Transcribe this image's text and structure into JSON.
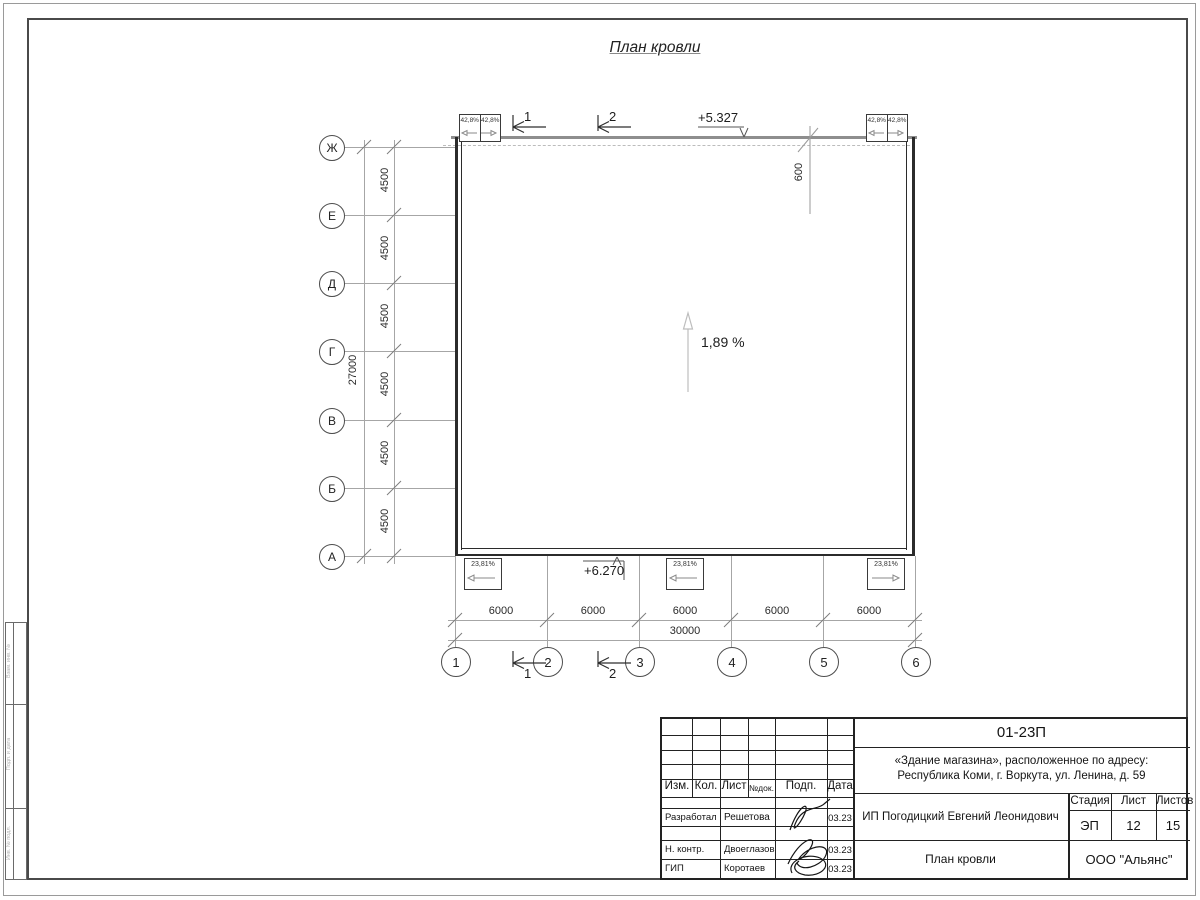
{
  "page": {
    "title": "План кровли"
  },
  "plan": {
    "slope_center": "1,89 %",
    "elevation_top": "+5.327",
    "elevation_bottom": "+6.270",
    "parapet_offset": "600",
    "section_marks": [
      "1",
      "2"
    ],
    "top_slope_cells": [
      "42,8%",
      "42,8%",
      "42,8%",
      "42,8%"
    ],
    "bottom_slope_cells": [
      "23,81%",
      "23,81%",
      "23,81%"
    ],
    "axes_letters": [
      "Ж",
      "Е",
      "Д",
      "Г",
      "В",
      "Б",
      "А"
    ],
    "axes_numbers": [
      "1",
      "2",
      "3",
      "4",
      "5",
      "6"
    ],
    "dims_vertical": [
      "4500",
      "4500",
      "4500",
      "4500",
      "4500",
      "4500"
    ],
    "dim_vertical_total": "27000",
    "dims_horizontal": [
      "6000",
      "6000",
      "6000",
      "6000",
      "6000"
    ],
    "dim_horizontal_total": "30000"
  },
  "titleblock": {
    "code": "01-23П",
    "project_line1": "«Здание магазина», расположенное по адресу:",
    "project_line2": "Республика Коми, г. Воркута, ул. Ленина, д. 59",
    "columns": {
      "izm": "Изм.",
      "kol": "Кол.",
      "list": "Лист",
      "ndok": "№док.",
      "podp": "Подп.",
      "data": "Дата"
    },
    "rows": [
      {
        "role": "Разработал",
        "name": "Решетова",
        "date": "03.23"
      },
      {
        "role": "Н. контр.",
        "name": "Двоеглазов",
        "date": "03.23"
      },
      {
        "role": "ГИП",
        "name": "Коротаев",
        "date": "03.23"
      }
    ],
    "client": "ИП Погодицкий Евгений Леонидович",
    "stage_label": "Стадия",
    "stage": "ЭП",
    "sheet_label": "Лист",
    "sheet": "12",
    "sheets_label": "Листов",
    "sheets": "15",
    "drawing_title": "План кровли",
    "company": "ООО \"Альянс\""
  },
  "side_stamp": {
    "cells": [
      "Взам. инв. №",
      "Подп. и дата",
      "Инв. № подл."
    ]
  },
  "colors": {
    "wall": "#2b2b2b",
    "grid": "#a6a6a6",
    "roof_edge": "#8e8e8e"
  }
}
